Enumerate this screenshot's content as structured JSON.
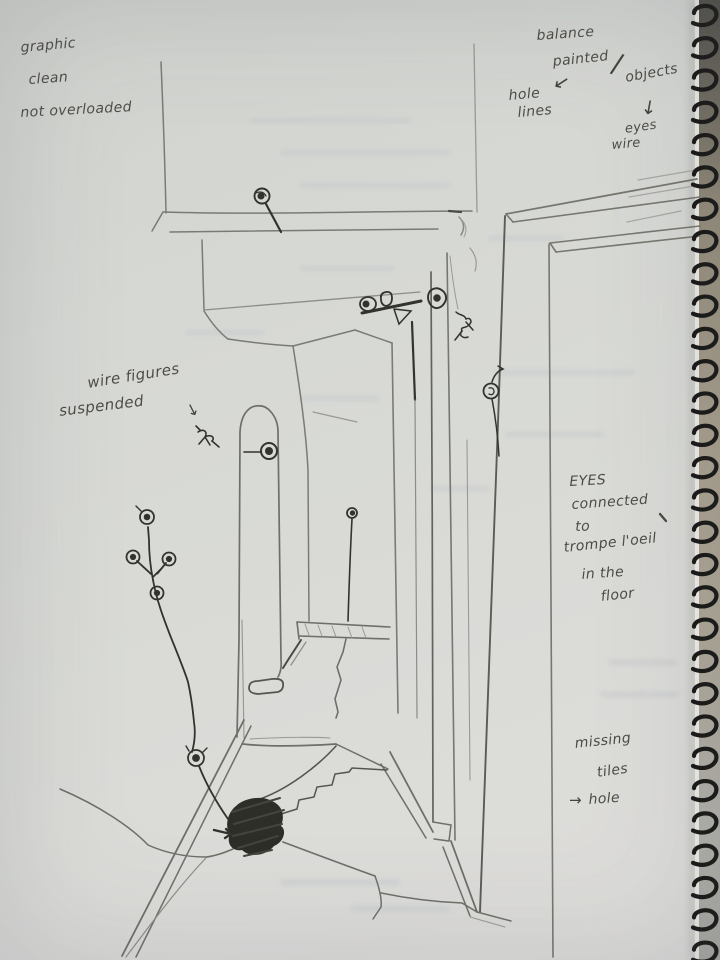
{
  "notes": {
    "graphic": "graphic",
    "clean": "clean",
    "not_overloaded": "not overloaded",
    "balance": "balance",
    "painted": "painted",
    "slash": "/",
    "objects": "objects",
    "arrow_painted": "↙",
    "hole_lines_1": "hole",
    "hole_lines_2": "lines",
    "arrow_objects": "↓",
    "eyes_wire_1": "eyes",
    "eyes_wire_2": "wire",
    "wire_figures": "wire figures",
    "suspended": "suspended",
    "arrow_figures": "↘",
    "eyes_caps": "EYES",
    "connected": "connected",
    "to": "to",
    "trompe": "trompe l'oeil",
    "in_the": "in the",
    "floor": "floor",
    "missing": "missing",
    "tiles": "tiles",
    "arrow_hole": "→",
    "hole_target": "hole"
  },
  "colors": {
    "paper": "#d8d9d5",
    "pencil_faint": "#9a9a94",
    "pencil_medium": "#7b7b75",
    "ink_dark": "#3a3a34",
    "spiral": "#171715"
  },
  "spiral": {
    "coil_count": 30
  }
}
